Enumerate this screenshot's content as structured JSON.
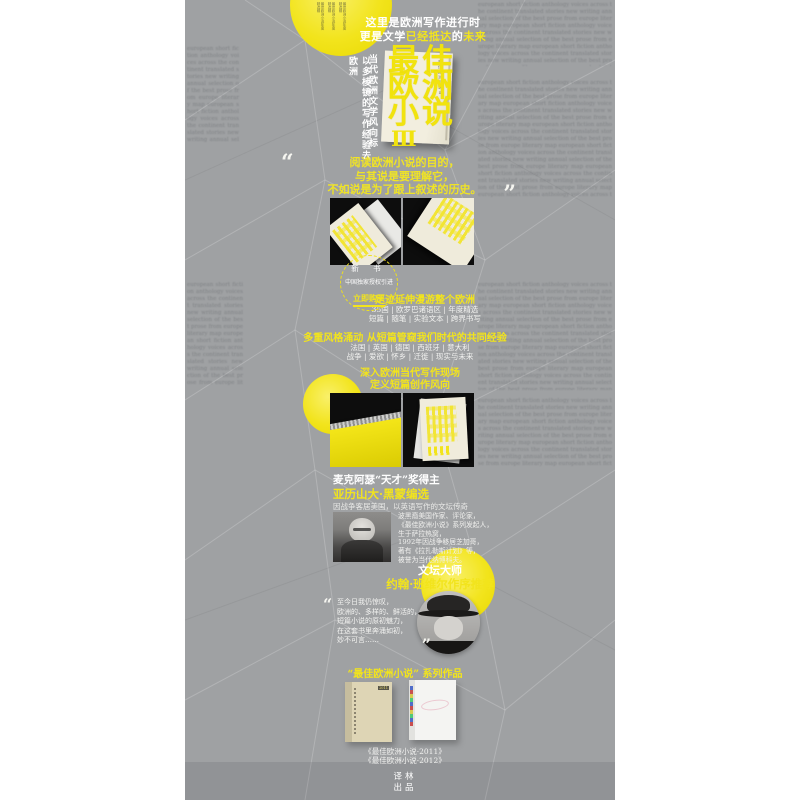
{
  "decor": {
    "filler": "european short fiction anthology voices across the continent translated stories new writing annual selection of the best prose from europe literary map",
    "credits": "最佳欧洲小说年度精选辑"
  },
  "colors": {
    "accent": "#f2e41c",
    "strip_bg": "#9fa1a3",
    "photo_bg": "#0d0d0d",
    "cream": "#efebdb"
  },
  "hero": {
    "tagline1": "这里是欧洲写作进行时",
    "tagline2_a": "更是文学",
    "tagline2_b": "已经抵达",
    "tagline2_c": "的",
    "tagline2_d": "未来",
    "vertical_right": "当代欧洲文学风向标",
    "vertical_left": "以多棱镜的写作经验去欧洲",
    "title_row1": "最佳",
    "title_row2": "欧洲",
    "title_row3": "小说",
    "title_roman": "Ⅲ",
    "cover_side_text": "最佳欧洲小说Ⅲ"
  },
  "quote1": {
    "open": "“",
    "close": "”",
    "lines": [
      "阅读欧洲小说的目的，",
      "与其说是要理解它，",
      "不如说是为了跟上叙述的历史。"
    ]
  },
  "badge": {
    "line1": "新 书",
    "line2": "中国独家授权引进",
    "cta": "立即购买"
  },
  "features": {
    "h1": "足迹延伸漫游整个欧洲",
    "sub1": [
      "35国 | 欧罗巴诸语区 | 年度精选",
      "短篇 | 随笔 | 实验文本 | 跨界书写"
    ],
    "h2": "多重风格涌动 从短篇管窥我们时代的共同经验",
    "sub2": [
      "法国 | 英国 | 德国 | 西班牙 | 意大利",
      "战争 | 爱欲 | 怀乡 | 迁徙 | 现实与未来"
    ],
    "h3_line1": "深入欧洲当代写作现场",
    "h3_line2": "定义短篇创作风向"
  },
  "editor": {
    "award": "麦克阿瑟“天才”奖得主",
    "name": "亚历山大·黑蒙编选",
    "note": "因战争客居美国，以英语写作的文坛传奇",
    "bio": [
      "波黑裔美国作家、评论家，",
      "《最佳欧洲小说》系列发起人，",
      "生于萨拉热窝，",
      "1992年因战争移居芝加哥，",
      "著有《拉扎勒斯计划》等，",
      "被誉为当代纳博科夫。"
    ]
  },
  "master": {
    "label": "文坛大师",
    "name": "约翰·班维尔作序推荐",
    "open": "“",
    "close": "”",
    "quote": [
      "至今日我仍惊叹，",
      "欧洲的、多样的、鲜活的，",
      "短篇小说的原初魅力，",
      "在这套书里奔涌如初，",
      "妙不可言……"
    ]
  },
  "series": {
    "heading": "“最佳欧洲小说” 系列作品",
    "left_label": "2011",
    "captions": [
      "《最佳欧洲小说·2011》",
      "《最佳欧洲小说·2012》"
    ]
  },
  "footer": {
    "line1": "译林",
    "line2": "出品"
  }
}
